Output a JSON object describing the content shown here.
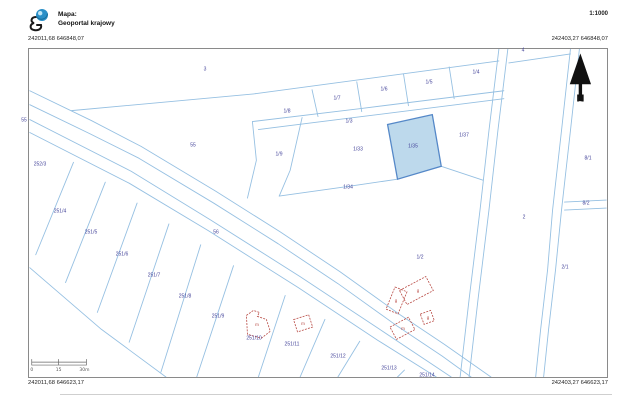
{
  "header": {
    "logo_icon": "geoportal-globe",
    "map_label": "Mapa:",
    "map_name": "Geoportal krajowy",
    "scale_text": "1:1000"
  },
  "corners": {
    "top_left": "242011,68 646848,07",
    "top_right": "242403,27 646848,07",
    "bottom_left": "242011,68 646623,17",
    "bottom_right": "242403,27 646623,17"
  },
  "north_arrow_label": "N",
  "scale_bar": {
    "start": "0",
    "middle": "15",
    "end": "30m"
  },
  "colors": {
    "parcel_line": "#96c0e2",
    "parcel_label": "#44449a",
    "highlight_fill": "#bdd9ec",
    "highlight_stroke": "#5588c8",
    "building": "#b84a44"
  },
  "map": {
    "highlighted_parcel": "1/35",
    "parcels": [
      {
        "label": "3",
        "x": 205,
        "y": 70
      },
      {
        "label": "4",
        "x": 523,
        "y": 51
      },
      {
        "label": "1/8",
        "x": 287,
        "y": 112
      },
      {
        "label": "1/7",
        "x": 337,
        "y": 99
      },
      {
        "label": "1/6",
        "x": 384,
        "y": 90
      },
      {
        "label": "1/5",
        "x": 429,
        "y": 83
      },
      {
        "label": "1/4",
        "x": 476,
        "y": 73
      },
      {
        "label": "1/3",
        "x": 349,
        "y": 122
      },
      {
        "label": "55",
        "x": 193,
        "y": 146
      },
      {
        "label": "55",
        "x": 24,
        "y": 121
      },
      {
        "label": "252/3",
        "x": 40,
        "y": 165
      },
      {
        "label": "1/9",
        "x": 279,
        "y": 155
      },
      {
        "label": "1/33",
        "x": 358,
        "y": 150
      },
      {
        "label": "1/35",
        "x": 413,
        "y": 147,
        "highlighted": true
      },
      {
        "label": "1/37",
        "x": 464,
        "y": 136
      },
      {
        "label": "1/34",
        "x": 348,
        "y": 188
      },
      {
        "label": "1/2",
        "x": 420,
        "y": 258
      },
      {
        "label": "2",
        "x": 524,
        "y": 218
      },
      {
        "label": "8/1",
        "x": 588,
        "y": 159
      },
      {
        "label": "8/2",
        "x": 586,
        "y": 204
      },
      {
        "label": "2/1",
        "x": 565,
        "y": 268
      },
      {
        "label": "56",
        "x": 216,
        "y": 233
      },
      {
        "label": "251/4",
        "x": 60,
        "y": 212
      },
      {
        "label": "251/5",
        "x": 91,
        "y": 233
      },
      {
        "label": "251/6",
        "x": 122,
        "y": 255
      },
      {
        "label": "251/7",
        "x": 154,
        "y": 276
      },
      {
        "label": "251/8",
        "x": 185,
        "y": 297
      },
      {
        "label": "251/9",
        "x": 218,
        "y": 317
      },
      {
        "label": "251/10",
        "x": 254,
        "y": 339
      },
      {
        "label": "251/11",
        "x": 292,
        "y": 345
      },
      {
        "label": "251/12",
        "x": 338,
        "y": 357
      },
      {
        "label": "251/13",
        "x": 389,
        "y": 369
      },
      {
        "label": "251/14",
        "x": 427,
        "y": 376
      }
    ],
    "building_labels": [
      {
        "label": "m",
        "x": 257,
        "y": 325
      },
      {
        "label": "m",
        "x": 303,
        "y": 324
      },
      {
        "label": "g",
        "x": 396,
        "y": 301
      },
      {
        "label": "g",
        "x": 418,
        "y": 291
      },
      {
        "label": "g",
        "x": 428,
        "y": 318
      },
      {
        "label": "m",
        "x": 403,
        "y": 329
      }
    ]
  }
}
